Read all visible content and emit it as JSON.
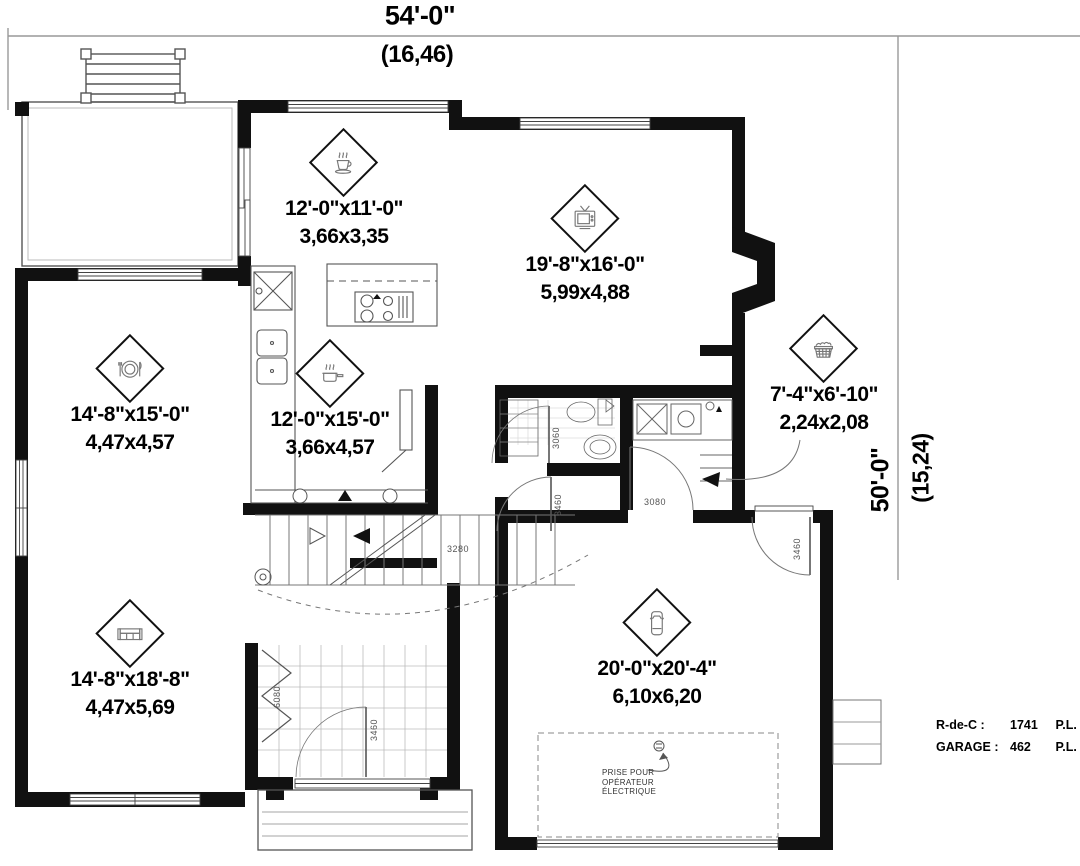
{
  "dimensions": {
    "top_feet": "54'-0\"",
    "top_metric": "(16,46)",
    "right_feet": "50'-0\"",
    "right_metric": "(15,24)"
  },
  "rooms": {
    "kitchen": {
      "icon": "coffee-cup-icon",
      "imperial": "12'-0\"x11'-0\"",
      "metric": "3,66x3,35"
    },
    "living": {
      "icon": "tv-icon",
      "imperial": "19'-8\"x16'-0\"",
      "metric": "5,99x4,88"
    },
    "dining": {
      "icon": "plate-cutlery-icon",
      "imperial": "14'-8\"x15'-0\"",
      "metric": "4,47x4,57"
    },
    "dinette": {
      "icon": "saucepan-icon",
      "imperial": "12'-0\"x15'-0\"",
      "metric": "3,66x4,57"
    },
    "laundry": {
      "icon": "laundry-basket-icon",
      "imperial": "7'-4\"x6'-10\"",
      "metric": "2,24x2,08"
    },
    "family": {
      "icon": "sofa-icon",
      "imperial": "14'-8\"x18'-8\"",
      "metric": "4,47x5,69"
    },
    "garage": {
      "icon": "car-icon",
      "imperial": "20'-0\"x20'-4\"",
      "metric": "6,10x6,20"
    }
  },
  "openings": {
    "bath_door": "3060",
    "hall_door": "3460",
    "mudroom_door": "3080",
    "stair_opening": "3280",
    "closet_door": "6080",
    "front_door": "3460",
    "garage_service_door": "3460"
  },
  "annotations": {
    "garage_outlet_line1": "PRISE POUR",
    "garage_outlet_line2": "OPÉRATEUR",
    "garage_outlet_line3": "ÉLECTRIQUE"
  },
  "legend": {
    "rows": [
      {
        "label": "R-de-C :",
        "value": "1741",
        "unit": "P.L."
      },
      {
        "label": "GARAGE :",
        "value": "462",
        "unit": "P.L."
      }
    ]
  }
}
